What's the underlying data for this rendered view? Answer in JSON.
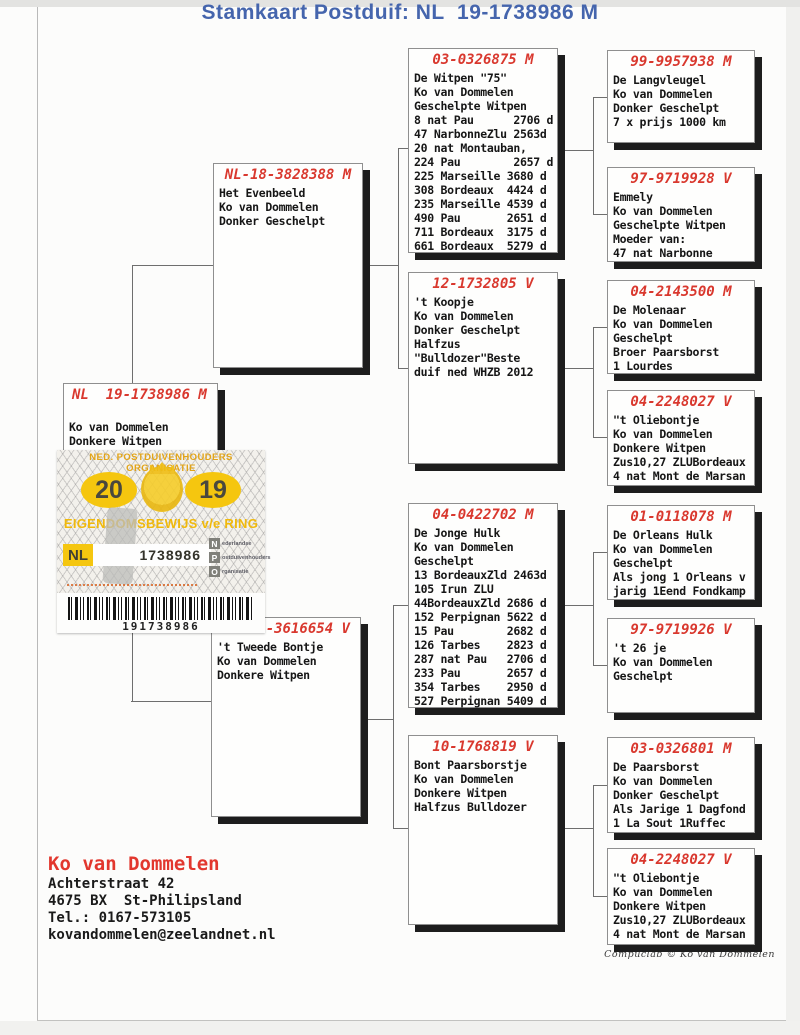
{
  "title": "Stamkaart Postduif: NL  19-1738986 M",
  "colors": {
    "title_blue": "#4565ad",
    "ring_red": "#d9382e",
    "sticker_yellow": "#f5c60f",
    "box_shadow_black": "#1d1d1d"
  },
  "subject": {
    "ring": "NL  19-1738986 M",
    "body": "\nKo van Dommelen\nDonkere Witpen"
  },
  "parents": [
    {
      "ring": "NL-18-3828388 M",
      "body": "Het Evenbeeld\nKo van Dommelen\nDonker Geschelpt"
    },
    {
      "ring": "-3616654 V",
      "body": "'t Tweede Bontje\nKo van Dommelen\nDonkere Witpen"
    }
  ],
  "grandparents": [
    {
      "ring": "03-0326875 M",
      "body": "De Witpen \"75\"\nKo van Dommelen\nGeschelpte Witpen\n8 nat Pau      2706 d\n47 NarbonneZlu 2563d\n20 nat Montauban,\n224 Pau        2657 d\n225 Marseille 3680 d\n308 Bordeaux  4424 d\n235 Marseille 4539 d\n490 Pau       2651 d\n711 Bordeaux  3175 d\n661 Bordeaux  5279 d"
    },
    {
      "ring": "12-1732805 V",
      "body": "'t Koopje\nKo van Dommelen\nDonker Geschelpt\nHalfzus\n\"Bulldozer\"Beste\nduif ned WHZB 2012"
    },
    {
      "ring": "04-0422702 M",
      "body": "De Jonge Hulk\nKo van Dommelen\nGeschelpt\n13 BordeauxZld 2463d\n105 Irun ZLU\n44BordeauxZld 2686 d\n152 Perpignan 5622 d\n15 Pau        2682 d\n126 Tarbes    2823 d\n287 nat Pau   2706 d\n233 Pau       2657 d\n354 Tarbes    2950 d\n527 Perpignan 5409 d"
    },
    {
      "ring": "10-1768819 V",
      "body": "Bont Paarsborstje\nKo van Dommelen\nDonkere Witpen\nHalfzus Bulldozer"
    }
  ],
  "great_grandparents": [
    {
      "ring": "99-9957938 M",
      "body": "De Langvleugel\nKo van Dommelen\nDonker Geschelpt\n7 x prijs 1000 km"
    },
    {
      "ring": "97-9719928 V",
      "body": "Emmely\nKo van Dommelen\nGeschelpte Witpen\nMoeder van:\n47 nat Narbonne"
    },
    {
      "ring": "04-2143500 M",
      "body": "De Molenaar\nKo van Dommelen\nGeschelpt\nBroer Paarsborst\n1 Lourdes"
    },
    {
      "ring": "04-2248027 V",
      "body": "\"t Oliebontje\nKo van Dommelen\nDonkere Witpen\nZus10,27 ZLUBordeaux\n4 nat Mont de Marsan"
    },
    {
      "ring": "01-0118078 M",
      "body": "De Orleans Hulk\nKo van Dommelen\nGeschelpt\nAls jong 1 Orleans v\njarig 1Eend Fondkamp"
    },
    {
      "ring": "97-9719926 V",
      "body": "'t 26 je\nKo van Dommelen\nGeschelpt"
    },
    {
      "ring": "03-0326801 M",
      "body": "De Paarsborst\nKo van Dommelen\nDonker Geschelpt\nAls Jarige 1 Dagfond\n1 La Sout 1Ruffec"
    },
    {
      "ring": "04-2248027 V",
      "body": "\"t Oliebontje\nKo van Dommelen\nDonkere Witpen\nZus10,27 ZLUBordeaux\n4 nat Mont de Marsan"
    }
  ],
  "sticker": {
    "org_line": "NED. POSTDUIVENHOUDERS ORGANISATIE",
    "year_left": "20",
    "year_right": "19",
    "title": "EIGENDOMSBEWIJS v/e RING",
    "country": "NL",
    "ring_number": "1738986",
    "npo": [
      {
        "letter": "N",
        "word": "ederlandse"
      },
      {
        "letter": "P",
        "word": "ostduivenhouders"
      },
      {
        "letter": "O",
        "word": "rganisatie"
      }
    ],
    "barcode_number": "191738986"
  },
  "owner": {
    "name": "Ko van Dommelen",
    "address": "Achterstraat 42\n4675 BX  St-Philipsland\nTel.: 0167-573105\nkovandommelen@zeelandnet.nl"
  },
  "credit": "Compuclab © Ko van Dommelen"
}
